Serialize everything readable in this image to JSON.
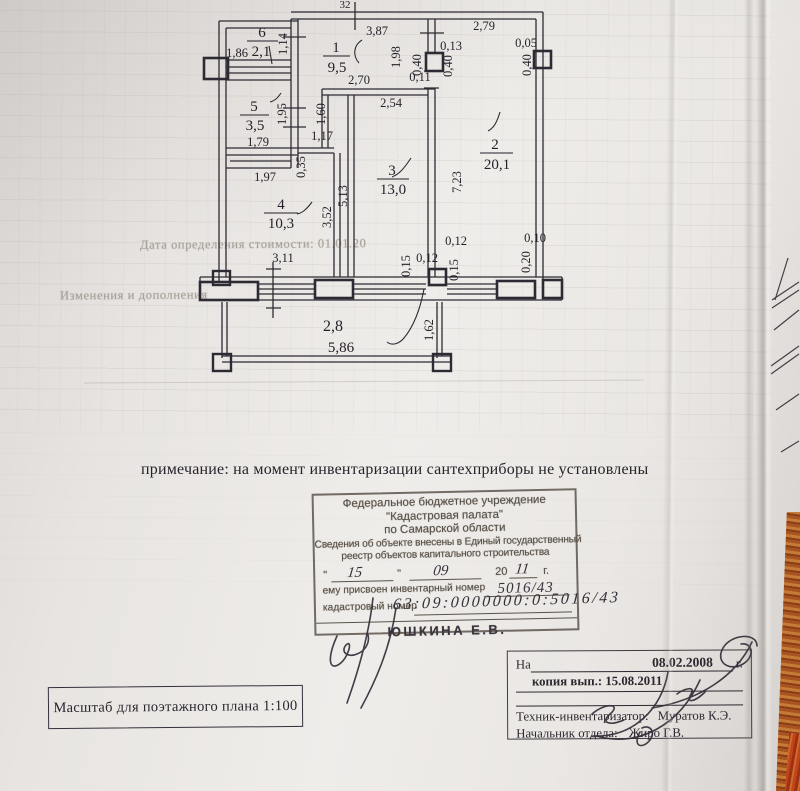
{
  "plan": {
    "rooms": [
      {
        "num": "1",
        "area": "9,5"
      },
      {
        "num": "2",
        "area": "20,1"
      },
      {
        "num": "3",
        "area": "13,0"
      },
      {
        "num": "4",
        "area": "10,3"
      },
      {
        "num": "5",
        "area": "3,5"
      },
      {
        "num": "6",
        "area": "2,1"
      }
    ],
    "dims": {
      "top_cut": "32",
      "r1_top": "3,87",
      "r2_top": "2,79",
      "r2_top_right": "0,05",
      "r6_width": "1,86",
      "r6_height": "1,14",
      "r1_right": "1,98",
      "col_offset": "0,13",
      "col_w_left": "0,40",
      "col_w_right": "0,40",
      "door_jamb": "0,11",
      "col_right_w": "0,40",
      "r1_bottom": "2,70",
      "r3_top": "2,54",
      "r1_left": "1,60",
      "r5_height": "1,95",
      "r5_width": "1,79",
      "niche_w": "1,17",
      "gap_w": "0,35",
      "r5_bottom": "1,97",
      "r3_height": "5,13",
      "r4_height": "3,52",
      "r2_height": "7,23",
      "r4_width": "3,11",
      "pier_w1": "0,12",
      "pier_h1": "0,15",
      "pier_w2": "0,12",
      "pier_h2": "0,15",
      "pier_w3": "0,10",
      "pier_h3": "0,20",
      "balc_depth": "1,62",
      "balc_area": "2,8",
      "balc_width": "5,86"
    }
  },
  "note": "примечание: на момент инвентаризации сантехприборы не установлены",
  "stamp": {
    "org1": "Федеральное бюджетное учреждение",
    "org2": "\"Кадастровая палата\"",
    "org3": "по Самарской области",
    "line1": "Сведения об объекте внесены в Единый государственный",
    "line2": "реестр объектов капитального строительства",
    "quote": "\"",
    "day": "15",
    "month": "09",
    "year_prefix": "20",
    "year": "11",
    "year_suffix": "г.",
    "inv_label": "ему присвоен инвентарный номер",
    "inv_value": "5016/43",
    "cad_label": "кадастровый номер",
    "cad_value": "63:09:0000000:0:5016/43",
    "signed_by": "Юшкина Е.В."
  },
  "footer_box": {
    "na_label": "На",
    "date": "08.02.2008",
    "year_suffix": "г.",
    "copy_label": "копия вып.:",
    "copy_value": "15.08.2011",
    "tech_label": "Техник-инвентаризатор:",
    "tech_name": "Муратов К.Э.",
    "head_label": "Начальник отдела:",
    "head_name": "Жиро Г.В."
  },
  "scale_box": "Масштаб для поэтажного плана 1:100",
  "bleed_through": [
    "Дата определения стоимости: 01.01.20",
    "Изменения и дополнения"
  ]
}
